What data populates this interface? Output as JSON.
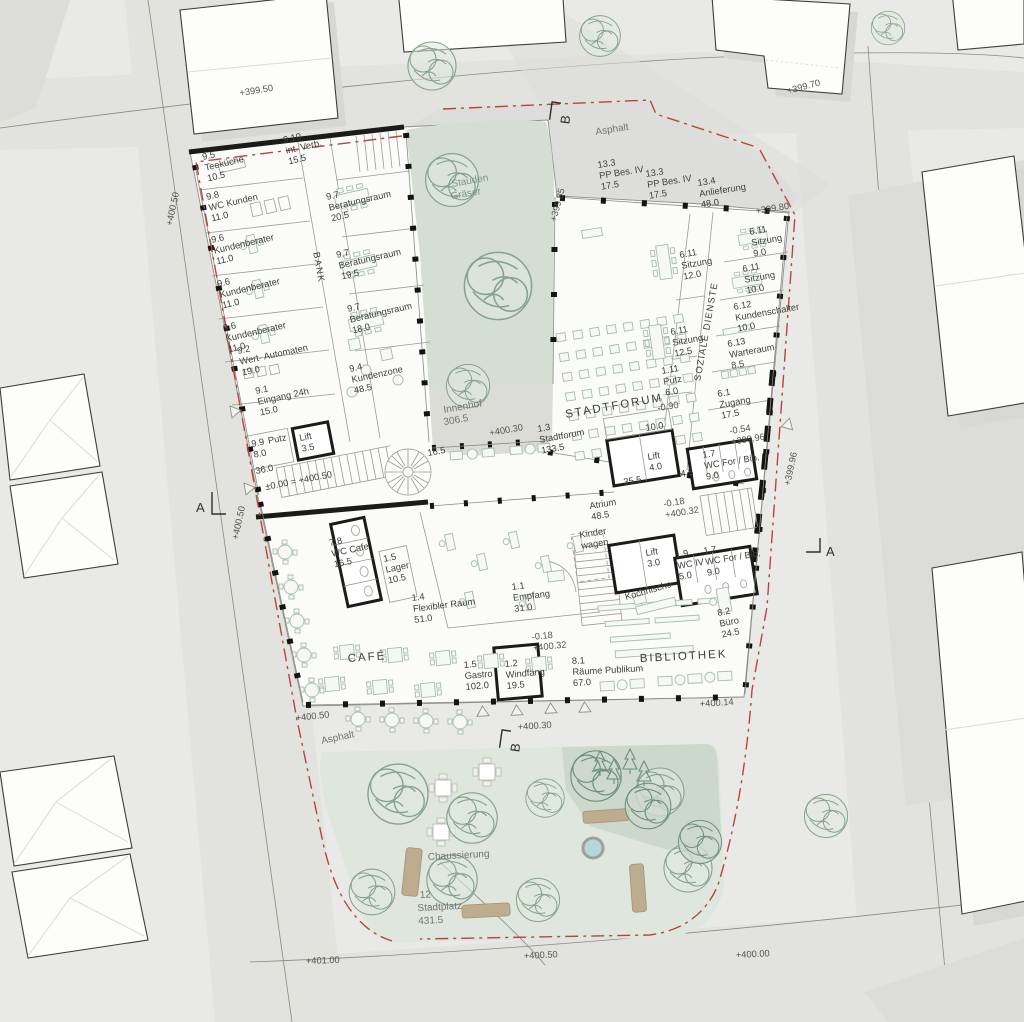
{
  "site": {
    "streets": {
      "asphalt_top": "Asphalt",
      "asphalt_left": "Asphalt"
    },
    "planting": {
      "line1": "Stauden",
      "line2": "Gräser"
    },
    "chaussierung": "Chaussierung",
    "stadtplatz": {
      "num": "12",
      "name": "Stadtplatz",
      "area": "431.5"
    },
    "innenhof": {
      "name": "Innenhof",
      "area": "306.5",
      "level": "+400.30"
    },
    "levels": {
      "street_tl": "+399.50",
      "street_tr": "+399.70",
      "anlieferung": "+399.80",
      "forum_w": "+399.85",
      "right": "+399.96",
      "bank_top": "+400.50",
      "bank_mid": "+400.50",
      "cafe": "+400.50",
      "promenade": "+400.30",
      "bib": "+400.14",
      "street_br": "+400.00",
      "street_bl": "+401.00",
      "platz": "+400.50"
    },
    "sections": {
      "a_left": "A",
      "a_right": "A",
      "b_top": "B",
      "b_bottom": "B"
    }
  },
  "bank": {
    "corridor": "BANK",
    "corridor_area": "36.0",
    "zero_level": "±0.00 = +400.50",
    "stair_area": "16.5",
    "rooms": [
      {
        "num": "9.5",
        "name": "Teeküche",
        "area": "10.5"
      },
      {
        "num": "9.10",
        "name": "int. Verb.",
        "area": "15.5"
      },
      {
        "num": "9.8",
        "name": "WC Kunden",
        "area": "11.0"
      },
      {
        "num": "9.6",
        "name": "Kundenberater",
        "area": "11.0"
      },
      {
        "num": "9.6",
        "name": "Kundenberater",
        "area": "11.0"
      },
      {
        "num": "9.6",
        "name": "Kundenberater",
        "area": "11.0"
      },
      {
        "num": "9.7",
        "name": "Beratungsraum",
        "area": "20.5"
      },
      {
        "num": "9.7",
        "name": "Beratungsraum",
        "area": "19.5"
      },
      {
        "num": "9.7",
        "name": "Beratungsraum",
        "area": "18.0"
      },
      {
        "num": "9.2",
        "name": "Wert- Automaten",
        "area": "19.0"
      },
      {
        "num": "9.4",
        "name": "Kundenzone",
        "area": "48.5"
      },
      {
        "num": "9.1",
        "name": "Eingang 24h",
        "area": "15.0"
      },
      {
        "num": "9.9",
        "name": "Putz",
        "area": "8.0"
      },
      {
        "num": "",
        "name": "Lift",
        "area": "3.5"
      }
    ]
  },
  "forum": {
    "title": "STADTFORUM",
    "room": {
      "num": "1.3",
      "name": "Stadtforum",
      "area": "133.5"
    },
    "level": "-0.90",
    "parking": [
      {
        "num": "13.3",
        "name": "PP Bes. IV",
        "area": "17.5"
      },
      {
        "num": "13.3",
        "name": "PP Bes. IV",
        "area": "17.5"
      }
    ],
    "delivery": {
      "num": "13.4",
      "name": "Anlieferung",
      "area": "48.0"
    }
  },
  "soziale": {
    "corridor": "SOZIALE DIENSTE",
    "rooms": [
      {
        "num": "6.11",
        "name": "Sitzung",
        "area": "12.0"
      },
      {
        "num": "6.11",
        "name": "Sitzung",
        "area": "12.5"
      },
      {
        "num": "1.11",
        "name": "Putz",
        "area": "6.0"
      },
      {
        "num": "6.11",
        "name": "Sitzung",
        "area": "9.0"
      },
      {
        "num": "6.11",
        "name": "Sitzung",
        "area": "10.0"
      },
      {
        "num": "6.12",
        "name": "Kundenschalter",
        "area": "10.0"
      },
      {
        "num": "6.13",
        "name": "Warteraum",
        "area": "8.5"
      },
      {
        "num": "6.1",
        "name": "Zugang",
        "area": "17.5"
      }
    ],
    "level": {
      "rel": "-0.54",
      "abs": "+399.96"
    }
  },
  "mitte": {
    "atrium": {
      "name": "Atrium",
      "area": "48.5"
    },
    "corridor_area": "35.5",
    "niche_area": "4.5",
    "room_area": "10.0",
    "lift_nord": {
      "name": "Lift",
      "area": "4.0"
    },
    "lift_sued": {
      "name": "Lift",
      "area": "3.0"
    },
    "wc_nord": {
      "num": "1.7",
      "name": "WC For / Bib.",
      "area": "9.0"
    },
    "wc_sued": {
      "num": "1.7",
      "name": "WC For / Bib.",
      "area": "9.0"
    },
    "wc_iv": {
      "num": "1.9",
      "name": "WC IV",
      "area": "5.0"
    },
    "kinderwagen": {
      "line1": "Kinder",
      "line2": "wagen"
    },
    "level": {
      "rel": "-0.18",
      "abs": "+400.32"
    }
  },
  "cafe": {
    "title": "CAFÉ",
    "rooms": [
      {
        "num": "7.8",
        "name": "WC Cafe",
        "area": "16.5"
      },
      {
        "num": "1.5",
        "name": "Lager",
        "area": "10.5"
      },
      {
        "num": "1.4",
        "name": "Flexibler Raum",
        "area": "51.0"
      },
      {
        "num": "1.5",
        "name": "Gastro",
        "area": "102.0"
      },
      {
        "num": "1.2",
        "name": "Windfang",
        "area": "19.5"
      },
      {
        "num": "1.1",
        "name": "Empfang",
        "area": "31.0"
      }
    ],
    "level": {
      "rel": "-0.18",
      "abs": "+400.32"
    }
  },
  "bibliothek": {
    "title": "BIBLIOTHEK",
    "rooms": [
      {
        "num": "8.2",
        "name": "Büro",
        "area": "24.5"
      },
      {
        "num": "8.1",
        "name": "Räume Publikum",
        "area": "67.0"
      },
      {
        "num": "",
        "name": "Kochnische",
        "area": ""
      }
    ]
  }
}
